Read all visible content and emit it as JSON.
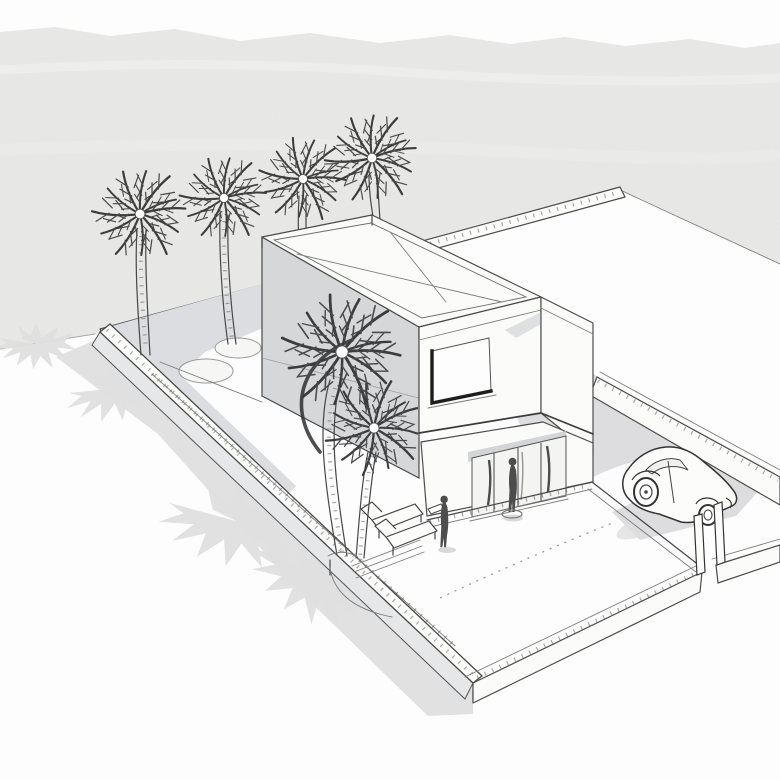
{
  "scene": {
    "title": "Villa concept sketch",
    "description": "Hand-drawn aerial perspective line sketch of a modern two-storey flat-roofed villa on a walled rectangular plot, with palm trees, a planting bed, sun loungers, two human figures and a beetle-style car parked on a grey driveway. Light grey textured sky band above, white ground with cast palm-tree and wall shadows."
  },
  "palette": {
    "paper": "#fdfdfd",
    "sky": "#e9e9e7",
    "sky_streak": "#f3f3f1",
    "shadow": "#dadada",
    "palm_shadow": "#e0e0e0",
    "face_shade": "#d6d7d9",
    "soffit_shade": "#cfd0d3",
    "garden_bed": "#dcdde0",
    "driveway": "#dddde0",
    "wall_outer": "#e6e7e9",
    "wall_top": "#fcfcfb",
    "line": "#474747",
    "dark_frame": "#1d1d1d"
  },
  "objects": {
    "house": {
      "storeys": 2,
      "roof": "flat roof with parapet",
      "window_upper": 1,
      "entrance_glass_doors": 1
    },
    "plot": {
      "walls": "perimeter wall on all four sides",
      "gates": [
        "pedestrian gate arc",
        "driveway gate posts"
      ]
    },
    "palm_trees_background": 4,
    "palm_trees_foreground": 2,
    "planting_circles": 2,
    "sun_loungers": 2,
    "side_table": 1,
    "figures": 2,
    "car": {
      "type": "beetle-style car",
      "position": "driveway near gate"
    },
    "cast_shadows": {
      "palm_star_shadows": 4,
      "wall_shadow_band": 1,
      "car_shadow": 1
    }
  }
}
